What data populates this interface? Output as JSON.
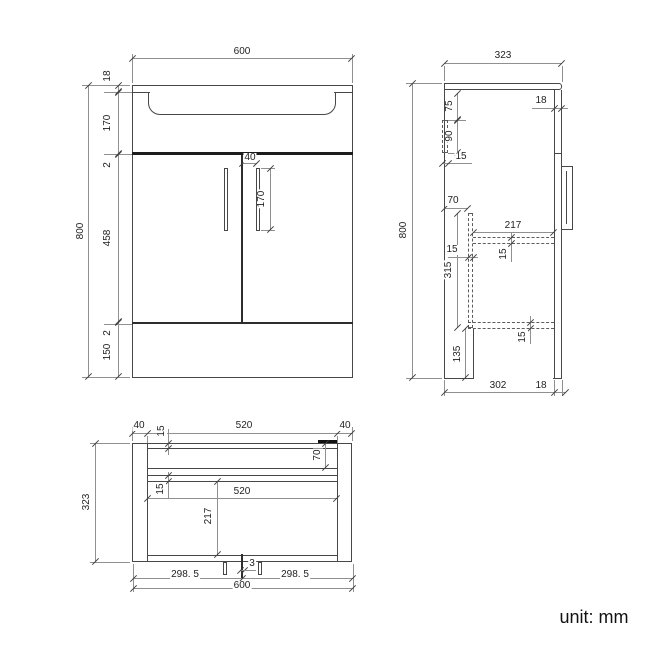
{
  "drawing_title": "vanity-unit-dimension-drawing",
  "unit_note": "unit: mm",
  "colors": {
    "object_line": "#474747",
    "dimension_line": "#909090",
    "text": "#1f1f1f",
    "background": "#ffffff"
  },
  "front_view": {
    "overall_width": "600",
    "overall_height": "800",
    "counter_thickness": "18",
    "basin_zone_height": "170",
    "gap_top": "2",
    "door_height": "458",
    "gap_bottom": "2",
    "plinth_height": "150",
    "handle_offset_from_center": "40",
    "handle_length": "170"
  },
  "side_view": {
    "overall_depth": "323",
    "overall_height": "800",
    "bracket_top_offset": "75",
    "bracket_height": "90",
    "bracket_thickness": "15",
    "door_thickness": "18",
    "divider_offset_from_back": "70",
    "divider_height": "315",
    "divider_thickness": "15",
    "shelf_depth": "217",
    "shelf_thickness": "15",
    "bottom_panel_thickness": "15",
    "plinth_height": "135",
    "body_depth": "302",
    "door_front_offset": "18"
  },
  "plan_view": {
    "side_panel_left": "40",
    "top_opening_width": "520",
    "side_panel_right": "40",
    "back_panel_thickness": "15",
    "back_rail_depth": "70",
    "rail_thickness": "15",
    "interior_width": "520",
    "shelf_depth": "217",
    "overall_depth": "323",
    "door_gap": "3",
    "left_door_width": "298. 5",
    "right_door_width": "298. 5",
    "overall_width": "600"
  }
}
